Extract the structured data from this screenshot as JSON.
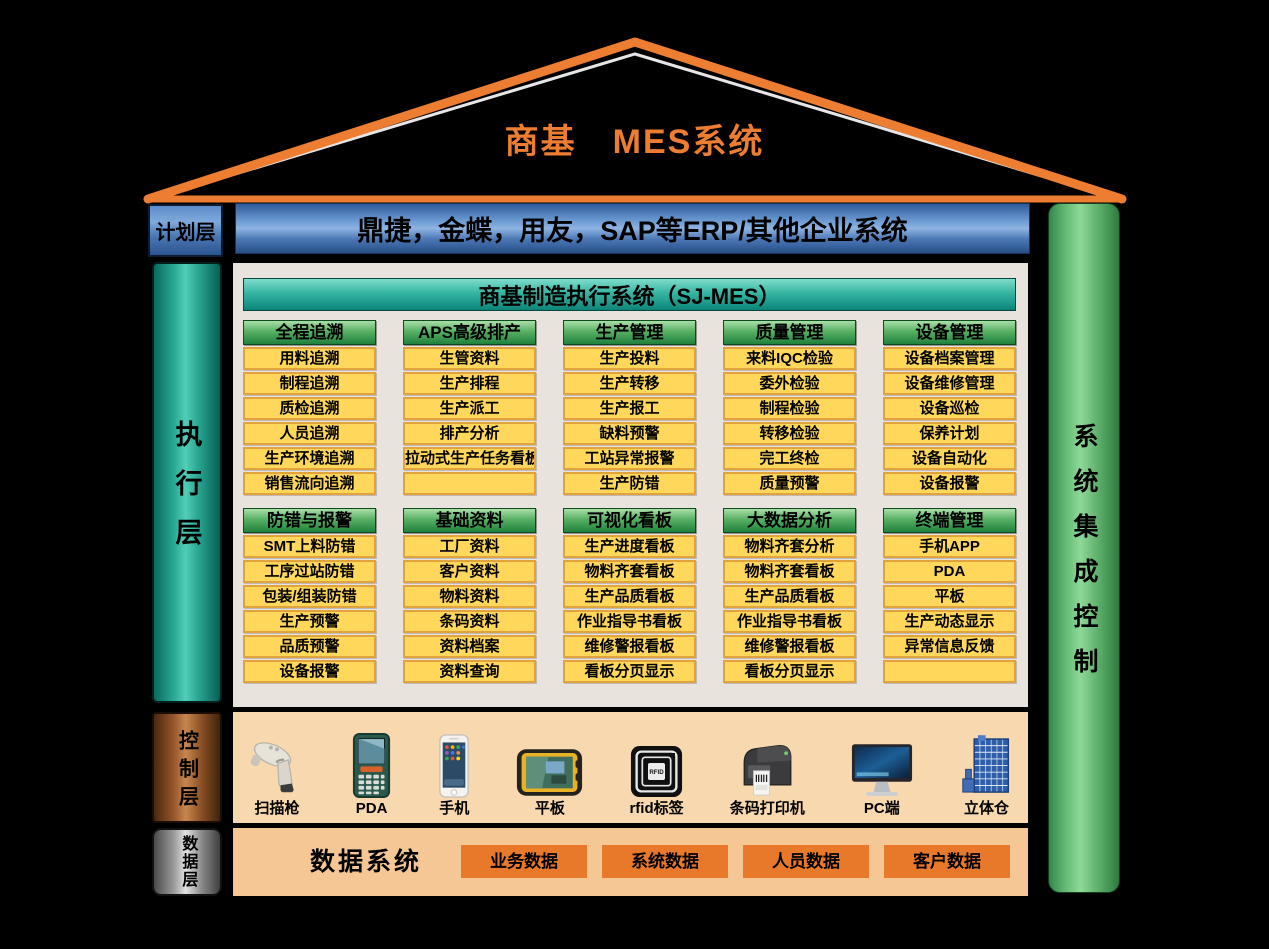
{
  "title": "商基　MES系统",
  "left_labels": {
    "plan": "计划层",
    "execution": "执行层",
    "control": "控制层",
    "data": "数据层"
  },
  "right_bar_label": "系统集成控制",
  "plan_layer": {
    "erp_bar": "鼎捷，金蝶，用友，SAP等ERP/其他企业系统"
  },
  "execution_layer": {
    "panel_title": "商基制造执行系统（SJ-MES）",
    "module_groups_row1": [
      {
        "header": "全程追溯",
        "items": [
          "用料追溯",
          "制程追溯",
          "质检追溯",
          "人员追溯",
          "生产环境追溯",
          "销售流向追溯"
        ]
      },
      {
        "header": "APS高级排产",
        "items": [
          "生管资料",
          "生产排程",
          "生产派工",
          "排产分析",
          "拉动式生产任务看板",
          ""
        ]
      },
      {
        "header": "生产管理",
        "items": [
          "生产投料",
          "生产转移",
          "生产报工",
          "缺料预警",
          "工站异常报警",
          "生产防错"
        ]
      },
      {
        "header": "质量管理",
        "items": [
          "来料IQC检验",
          "委外检验",
          "制程检验",
          "转移检验",
          "完工终检",
          "质量预警"
        ]
      },
      {
        "header": "设备管理",
        "items": [
          "设备档案管理",
          "设备维修管理",
          "设备巡检",
          "保养计划",
          "设备自动化",
          "设备报警"
        ]
      }
    ],
    "module_groups_row2": [
      {
        "header": "防错与报警",
        "items": [
          "SMT上料防错",
          "工序过站防错",
          "包装/组装防错",
          "生产预警",
          "品质预警",
          "设备报警"
        ]
      },
      {
        "header": "基础资料",
        "items": [
          "工厂资料",
          "客户资料",
          "物料资料",
          "条码资料",
          "资料档案",
          "资料查询"
        ]
      },
      {
        "header": "可视化看板",
        "items": [
          "生产进度看板",
          "物料齐套看板",
          "生产品质看板",
          "作业指导书看板",
          "维修警报看板",
          "看板分页显示"
        ]
      },
      {
        "header": "大数据分析",
        "items": [
          "物料齐套分析",
          "物料齐套看板",
          "生产品质看板",
          "作业指导书看板",
          "维修警报看板",
          "看板分页显示"
        ]
      },
      {
        "header": "终端管理",
        "items": [
          "手机APP",
          "PDA",
          "平板",
          "生产动态显示",
          "异常信息反馈",
          ""
        ]
      }
    ]
  },
  "control_layer": {
    "devices": [
      {
        "label": "扫描枪",
        "icon": "barcode-scanner"
      },
      {
        "label": "PDA",
        "icon": "pda-handheld"
      },
      {
        "label": "手机",
        "icon": "smartphone"
      },
      {
        "label": "平板",
        "icon": "rugged-tablet"
      },
      {
        "label": "rfid标签",
        "icon": "rfid-tag"
      },
      {
        "label": "条码打印机",
        "icon": "barcode-printer"
      },
      {
        "label": "PC端",
        "icon": "desktop-monitor"
      },
      {
        "label": "立体仓",
        "icon": "warehouse-rack"
      }
    ]
  },
  "data_layer": {
    "system_label": "数据系统",
    "boxes": [
      "业务数据",
      "系统数据",
      "人员数据",
      "客户数据"
    ]
  },
  "colors": {
    "background": "#000000",
    "roof_orange": "#ED7D31",
    "title_orange": "#ED7D31",
    "erp_blue": "#3C6BAA",
    "teal_bar": "#18A795",
    "green_header": "#3E9E53",
    "integration_green": "#6FBE7E",
    "module_yellow": "#FFD75A",
    "module_border": "#E2A33C",
    "panel_bg": "#E9E3DE",
    "control_peach": "#F8D8AE",
    "data_peach": "#F5C795",
    "copper_bar": "#A86A3C",
    "gray_bar": "#9A9A9A",
    "data_box_orange": "#E8782A"
  }
}
